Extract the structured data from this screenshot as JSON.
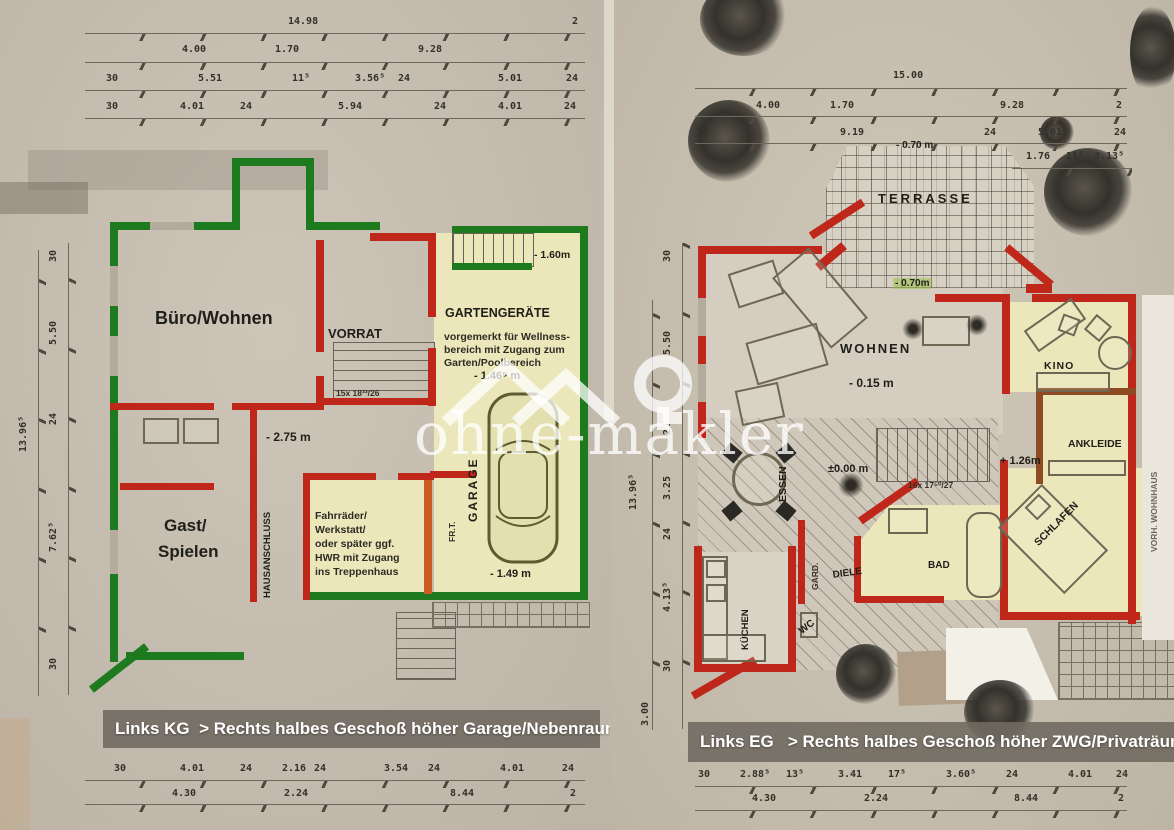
{
  "watermark": {
    "text": "ohne-makler"
  },
  "left_plan": {
    "caption": "Links KG  > Rechts halbes Geschoß höher Garage/Nebenraum",
    "dims": [
      {
        "t": "14.98",
        "x": 288,
        "y": 16
      },
      {
        "t": "2",
        "x": 572,
        "y": 16
      },
      {
        "t": "4.00",
        "x": 182,
        "y": 44
      },
      {
        "t": "1.70",
        "x": 275,
        "y": 44
      },
      {
        "t": "9.28",
        "x": 418,
        "y": 44
      },
      {
        "t": "30",
        "x": 106,
        "y": 73
      },
      {
        "t": "5.51",
        "x": 198,
        "y": 73
      },
      {
        "t": "11⁵",
        "x": 292,
        "y": 73
      },
      {
        "t": "3.56⁵",
        "x": 355,
        "y": 73
      },
      {
        "t": "24",
        "x": 398,
        "y": 73
      },
      {
        "t": "5.01",
        "x": 498,
        "y": 73
      },
      {
        "t": "24",
        "x": 566,
        "y": 73
      },
      {
        "t": "30",
        "x": 106,
        "y": 101
      },
      {
        "t": "4.01",
        "x": 180,
        "y": 101
      },
      {
        "t": "24",
        "x": 240,
        "y": 101
      },
      {
        "t": "5.94",
        "x": 338,
        "y": 101
      },
      {
        "t": "24",
        "x": 434,
        "y": 101
      },
      {
        "t": "4.01",
        "x": 498,
        "y": 101
      },
      {
        "t": "24",
        "x": 564,
        "y": 101
      },
      {
        "t": "30",
        "x": 48,
        "y": 262,
        "r": -90
      },
      {
        "t": "5.50",
        "x": 48,
        "y": 345,
        "r": -90
      },
      {
        "t": "24",
        "x": 48,
        "y": 425,
        "r": -90
      },
      {
        "t": "7.62⁵",
        "x": 48,
        "y": 552,
        "r": -90
      },
      {
        "t": "30",
        "x": 48,
        "y": 670,
        "r": -90
      },
      {
        "t": "13.96⁵",
        "x": 18,
        "y": 452,
        "r": -90
      },
      {
        "t": "30",
        "x": 114,
        "y": 763
      },
      {
        "t": "4.01",
        "x": 180,
        "y": 763
      },
      {
        "t": "24",
        "x": 240,
        "y": 763
      },
      {
        "t": "2.16",
        "x": 282,
        "y": 763
      },
      {
        "t": "24",
        "x": 314,
        "y": 763
      },
      {
        "t": "3.54",
        "x": 384,
        "y": 763
      },
      {
        "t": "24",
        "x": 428,
        "y": 763
      },
      {
        "t": "4.01",
        "x": 500,
        "y": 763
      },
      {
        "t": "24",
        "x": 562,
        "y": 763
      },
      {
        "t": "4.30",
        "x": 172,
        "y": 788
      },
      {
        "t": "2.24",
        "x": 284,
        "y": 788
      },
      {
        "t": "8.44",
        "x": 450,
        "y": 788
      },
      {
        "t": "2",
        "x": 570,
        "y": 788
      }
    ],
    "labels": [
      {
        "t": "Büro/Wohnen",
        "x": 155,
        "y": 308,
        "c": "room",
        "fs": 18
      },
      {
        "t": "VORRAT",
        "x": 328,
        "y": 326,
        "c": "room",
        "fs": 13
      },
      {
        "t": "GARTENGERÄTE",
        "x": 445,
        "y": 306,
        "c": "room",
        "fs": 12.5
      },
      {
        "t": "vorgemerkt für Wellness-",
        "x": 444,
        "y": 331,
        "c": "note"
      },
      {
        "t": "bereich mit Zugang zum",
        "x": 444,
        "y": 344,
        "c": "note"
      },
      {
        "t": "Garten/Poolbereich",
        "x": 444,
        "y": 357,
        "c": "note"
      },
      {
        "t": "- 1.60m",
        "x": 534,
        "y": 249,
        "c": "elev",
        "fs": 10.5
      },
      {
        "t": "- 1.46⁵ m",
        "x": 474,
        "y": 370,
        "c": "elev",
        "fs": 11
      },
      {
        "t": "- 2.75 m",
        "x": 266,
        "y": 430,
        "c": "elev",
        "fs": 12
      },
      {
        "t": "Gast/",
        "x": 164,
        "y": 516,
        "c": "room",
        "fs": 17
      },
      {
        "t": "Spielen",
        "x": 158,
        "y": 542,
        "c": "room",
        "fs": 17
      },
      {
        "t": "HAUSANSCHLUSS",
        "x": 262,
        "y": 598,
        "c": "room",
        "fs": 9.5,
        "r": -90
      },
      {
        "t": "Fahrräder/",
        "x": 315,
        "y": 510,
        "c": "note"
      },
      {
        "t": "Werkstatt/",
        "x": 315,
        "y": 524,
        "c": "note"
      },
      {
        "t": "oder später ggf.",
        "x": 315,
        "y": 538,
        "c": "note"
      },
      {
        "t": "HWR mit Zugang",
        "x": 315,
        "y": 552,
        "c": "note"
      },
      {
        "t": "ins Treppenhaus",
        "x": 315,
        "y": 566,
        "c": "note"
      },
      {
        "t": "FR.T.",
        "x": 447,
        "y": 542,
        "c": "tiny",
        "r": -90
      },
      {
        "t": "GARAGE",
        "x": 466,
        "y": 522,
        "c": "room",
        "fs": 12,
        "ls": 2,
        "r": -90
      },
      {
        "t": "- 1.49 m",
        "x": 490,
        "y": 568,
        "c": "elev",
        "fs": 11
      },
      {
        "t": "15x 18³³/26",
        "x": 336,
        "y": 388,
        "c": "tiny"
      }
    ]
  },
  "right_plan": {
    "caption": "Links EG   > Rechts halbes Geschoß höher ZWG/Privaträume",
    "dims": [
      {
        "t": "15.00",
        "x": 893,
        "y": 70
      },
      {
        "t": "4.00",
        "x": 756,
        "y": 100
      },
      {
        "t": "1.70",
        "x": 830,
        "y": 100
      },
      {
        "t": "9.28",
        "x": 1000,
        "y": 100
      },
      {
        "t": "2",
        "x": 1116,
        "y": 100
      },
      {
        "t": "30",
        "x": 696,
        "y": 127
      },
      {
        "t": "9.19",
        "x": 840,
        "y": 127
      },
      {
        "t": "24",
        "x": 984,
        "y": 127
      },
      {
        "t": "5.01",
        "x": 1038,
        "y": 127
      },
      {
        "t": "24",
        "x": 1114,
        "y": 127
      },
      {
        "t": "1.76",
        "x": 1026,
        "y": 151
      },
      {
        "t": "11⁵",
        "x": 1066,
        "y": 151
      },
      {
        "t": "3.13⁵",
        "x": 1094,
        "y": 151
      },
      {
        "t": "30",
        "x": 662,
        "y": 262,
        "r": -90
      },
      {
        "t": "5.50",
        "x": 662,
        "y": 355,
        "r": -90
      },
      {
        "t": "24",
        "x": 662,
        "y": 435,
        "r": -90
      },
      {
        "t": "3.25",
        "x": 662,
        "y": 500,
        "r": -90
      },
      {
        "t": "24",
        "x": 662,
        "y": 540,
        "r": -90
      },
      {
        "t": "4.13⁵",
        "x": 662,
        "y": 612,
        "r": -90
      },
      {
        "t": "30",
        "x": 662,
        "y": 672,
        "r": -90
      },
      {
        "t": "3.00",
        "x": 640,
        "y": 726,
        "r": -90
      },
      {
        "t": "13.96⁵",
        "x": 628,
        "y": 510,
        "r": -90
      },
      {
        "t": "30",
        "x": 698,
        "y": 769
      },
      {
        "t": "2.88⁵",
        "x": 740,
        "y": 769
      },
      {
        "t": "13⁵",
        "x": 786,
        "y": 769
      },
      {
        "t": "3.41",
        "x": 838,
        "y": 769
      },
      {
        "t": "17⁵",
        "x": 888,
        "y": 769
      },
      {
        "t": "3.60⁵",
        "x": 946,
        "y": 769
      },
      {
        "t": "24",
        "x": 1006,
        "y": 769
      },
      {
        "t": "4.01",
        "x": 1068,
        "y": 769
      },
      {
        "t": "24",
        "x": 1116,
        "y": 769
      },
      {
        "t": "4.30",
        "x": 752,
        "y": 793
      },
      {
        "t": "2.24",
        "x": 864,
        "y": 793
      },
      {
        "t": "8.44",
        "x": 1014,
        "y": 793
      },
      {
        "t": "2",
        "x": 1118,
        "y": 793
      }
    ],
    "labels": [
      {
        "t": "TERRASSE",
        "x": 878,
        "y": 191,
        "c": "room",
        "fs": 13,
        "ls": 3
      },
      {
        "t": "- 0.70 m",
        "x": 896,
        "y": 140,
        "c": "elev",
        "fs": 10
      },
      {
        "t": "- 0.70m",
        "x": 893,
        "y": 278,
        "c": "elev elevg",
        "fs": 10
      },
      {
        "t": "WOHNEN",
        "x": 840,
        "y": 341,
        "c": "room",
        "fs": 13,
        "ls": 2
      },
      {
        "t": "- 0.15 m",
        "x": 849,
        "y": 376,
        "c": "elev",
        "fs": 12
      },
      {
        "t": "KINO",
        "x": 1044,
        "y": 360,
        "c": "room",
        "fs": 10.5,
        "ls": 1
      },
      {
        "t": "ANKLEIDE",
        "x": 1068,
        "y": 438,
        "c": "room",
        "fs": 10.5
      },
      {
        "t": "+ 1.26m",
        "x": 1000,
        "y": 455,
        "c": "elev",
        "fs": 11
      },
      {
        "t": "SCHLAFEN",
        "x": 1032,
        "y": 540,
        "c": "room",
        "fs": 10.5,
        "r": -45
      },
      {
        "t": "ESSEN",
        "x": 777,
        "y": 502,
        "c": "room",
        "fs": 10.5,
        "r": -90
      },
      {
        "t": "±0.00 m",
        "x": 828,
        "y": 463,
        "c": "elev",
        "fs": 11
      },
      {
        "t": "16x 17⁵⁰/27",
        "x": 908,
        "y": 480,
        "c": "tiny"
      },
      {
        "t": "GARD.",
        "x": 810,
        "y": 590,
        "c": "tiny",
        "r": -90
      },
      {
        "t": "DIELE",
        "x": 832,
        "y": 570,
        "c": "room",
        "fs": 10,
        "r": -8
      },
      {
        "t": "BAD",
        "x": 928,
        "y": 560,
        "c": "room",
        "fs": 10
      },
      {
        "t": "KÜCHEN",
        "x": 740,
        "y": 650,
        "c": "room",
        "fs": 9.5,
        "r": -90
      },
      {
        "t": "WC",
        "x": 797,
        "y": 628,
        "c": "room",
        "fs": 10,
        "r": -38
      },
      {
        "t": "VORH. WOHNHAUS",
        "x": 1149,
        "y": 552,
        "c": "tiny tiny2",
        "r": -90
      }
    ]
  }
}
